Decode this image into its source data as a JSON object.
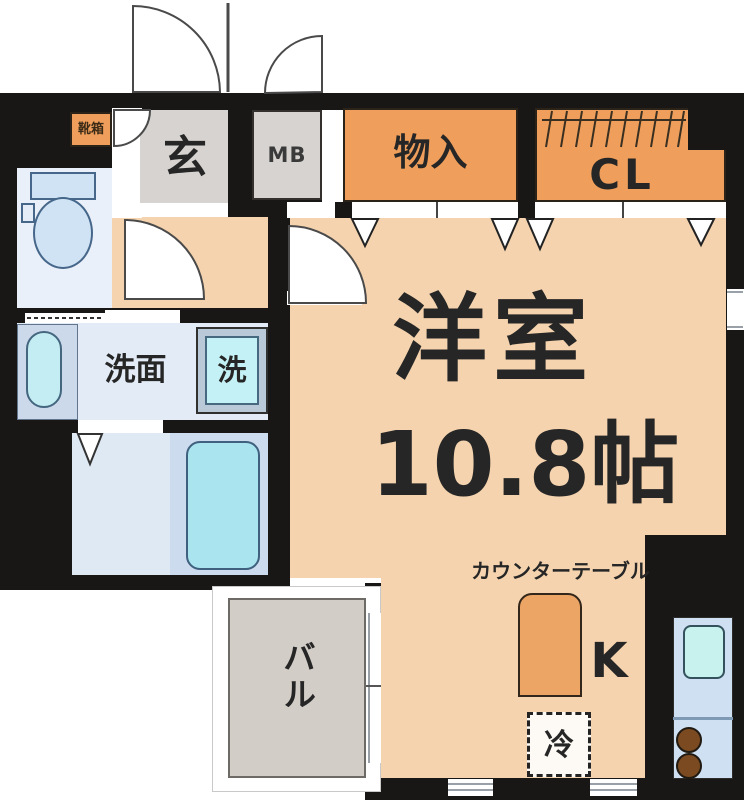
{
  "plan": {
    "title": "1R apartment floor plan",
    "rooms": {
      "genkan": {
        "label": "玄"
      },
      "meter_box": {
        "label": "MB"
      },
      "shoe_box": {
        "label": "靴箱"
      },
      "storage": {
        "label": "物入"
      },
      "closet": {
        "label": "CL"
      },
      "main_room": {
        "name": "洋室",
        "size": "10.8帖"
      },
      "washroom": {
        "label": "洗面"
      },
      "washer": {
        "label": "洗"
      },
      "balcony": {
        "label": "バル"
      },
      "kitchen": {
        "label": "K",
        "counter_label": "カウンターテーブル",
        "fridge_label": "冷"
      }
    },
    "colors": {
      "wall": "#181716",
      "floor_orange": "#f4d3ae",
      "closet_orange": "#ef9f5b",
      "genkan_gray": "#d6d3d0",
      "balcony_gray": "#d3cdc7",
      "water_blue": "#cfe2f4",
      "tub_cyan": "#a9e4ef",
      "counter_orange": "#eda566",
      "burner_brown": "#7b4a20"
    }
  }
}
